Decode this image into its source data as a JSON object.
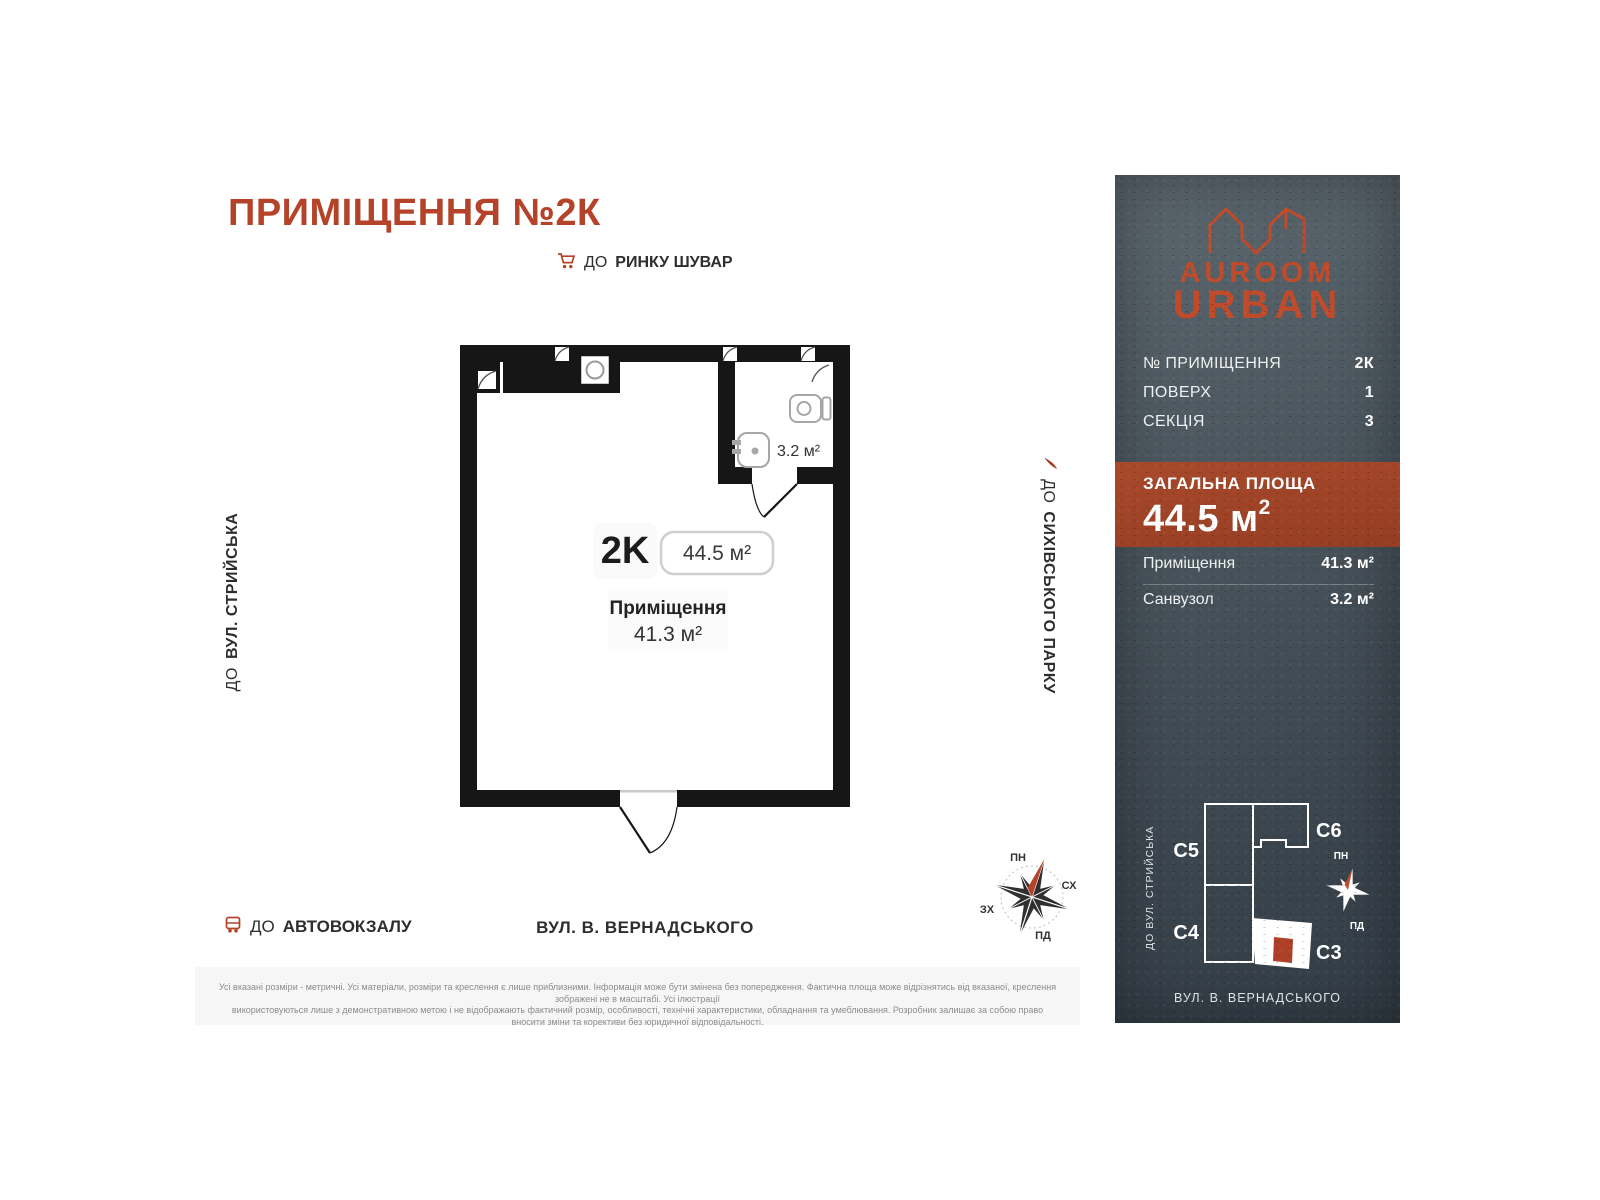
{
  "header": {
    "title": "ПРИМІЩЕННЯ №2К"
  },
  "directions": {
    "market": {
      "prefix": "ДО",
      "name": "РИНКУ ШУВАР"
    },
    "left_street": {
      "prefix": "ДО",
      "name": "ВУЛ. СТРИЙСЬКА"
    },
    "park": {
      "prefix": "ДО",
      "name": "СИХІВСЬКОГО ПАРКУ"
    },
    "bus": {
      "prefix": "ДО",
      "name": "АВТОВОКЗАЛУ"
    },
    "bottom_street": "ВУЛ. В. ВЕРНАДСЬКОГО"
  },
  "plan": {
    "unit": "2K",
    "total_area": "44.5 м²",
    "room_label": "Приміщення",
    "room_area": "41.3 м²",
    "bath_area": "3.2 м²"
  },
  "compass": {
    "north": "ПН",
    "east": "СХ",
    "west": "ЗХ",
    "south": "ПД"
  },
  "panel": {
    "brand_top": "AUROOM",
    "brand_bottom": "URBAN",
    "rows": [
      {
        "label": "№ ПРИМІЩЕННЯ",
        "value": "2К"
      },
      {
        "label": "ПОВЕРХ",
        "value": "1"
      },
      {
        "label": "СЕКЦІЯ",
        "value": "3"
      }
    ],
    "total_label": "ЗАГАЛЬНА ПЛОЩА",
    "total_value": "44.5 м",
    "total_sup": "2",
    "areas": [
      {
        "label": "Приміщення",
        "value": "41.3 м²"
      },
      {
        "label": "Санвузол",
        "value": "3.2 м²"
      }
    ],
    "minimap": {
      "c5": "C5",
      "c6": "C6",
      "c4": "C4",
      "c3": "C3",
      "left_street": "ДО ВУЛ. СТРИЙСЬКА",
      "bottom_street": "ВУЛ. В. ВЕРНАДСЬКОГО",
      "north": "ПН",
      "south": "ПД"
    }
  },
  "disclaimer": {
    "line1": "Усі вказані розміри - метричні. Усі матеріали, розміри та креслення є лише приблизними. Інформація може бути змінена без попередження. Фактична площа може відрізнятись від вказаної, креслення зображені не в масштабі. Усі ілюстрації",
    "line2": "використовуються лише з демонстративною метою і не відображають фактичний розмір, особливості, технічні характеристики, обладнання та умеблювання. Розробник залишає за собою право вносити зміни та корективи без юридичної відповідальності."
  },
  "colors": {
    "brand_red": "#b5432a",
    "band_red": "#9d4226",
    "panel_dark": "#3a444d",
    "wall_black": "#161616"
  }
}
